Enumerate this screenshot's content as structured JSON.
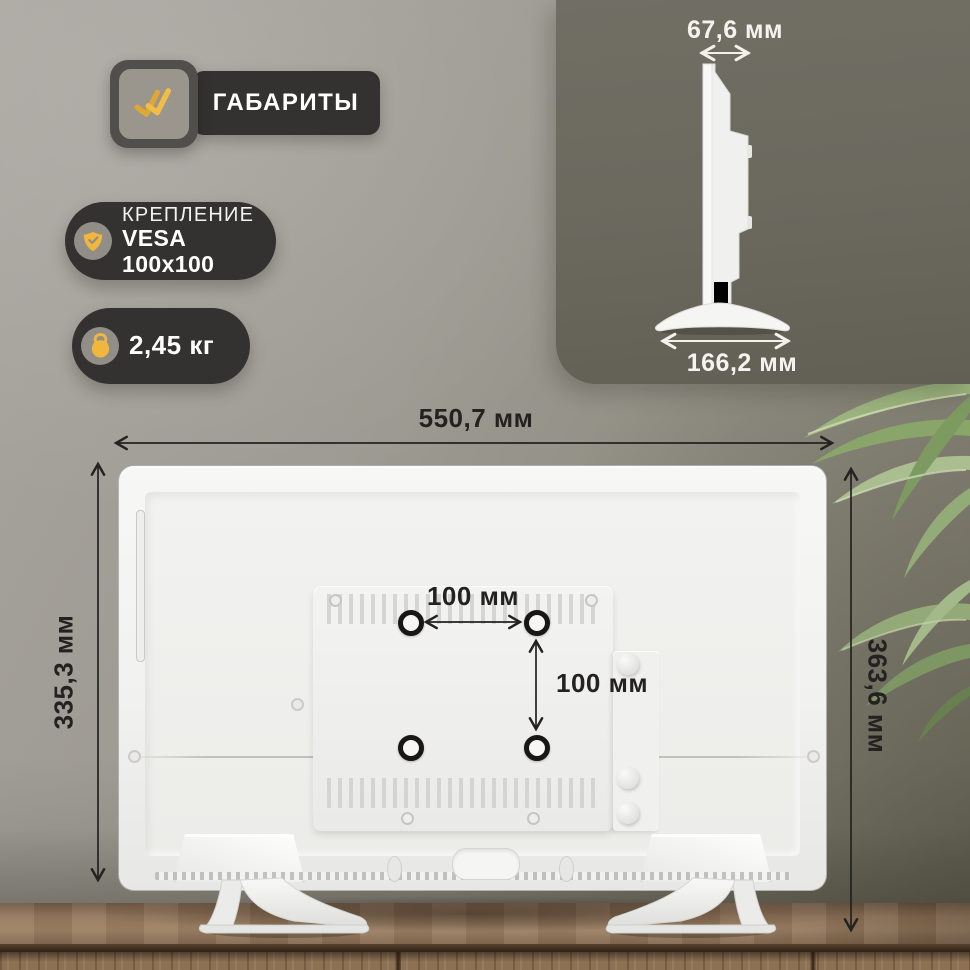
{
  "header_badge": {
    "label": "ГАБАРИТЫ",
    "icon": "double-check-icon"
  },
  "badges": {
    "mount": {
      "title": "КРЕПЛЕНИЕ",
      "value": "VESA 100x100",
      "icon": "shield-check-icon"
    },
    "weight": {
      "value": "2,45 кг",
      "icon": "kettlebell-icon"
    }
  },
  "side_view": {
    "depth": "67,6 мм",
    "stand_width": "166,2 мм"
  },
  "back_view": {
    "width": "550,7 мм",
    "height": "335,3 мм",
    "height_with_stand": "363,6 мм",
    "vesa_width": "100 мм",
    "vesa_height": "100 мм",
    "mount_holes": 4
  },
  "colors": {
    "accent_yellow": "#EDB53C",
    "badge_bg": "#343231",
    "panel_bg": "#6B695E",
    "dim_text": "#232220",
    "tv_body": "#F4F4F3",
    "wood": "#8F7355"
  }
}
